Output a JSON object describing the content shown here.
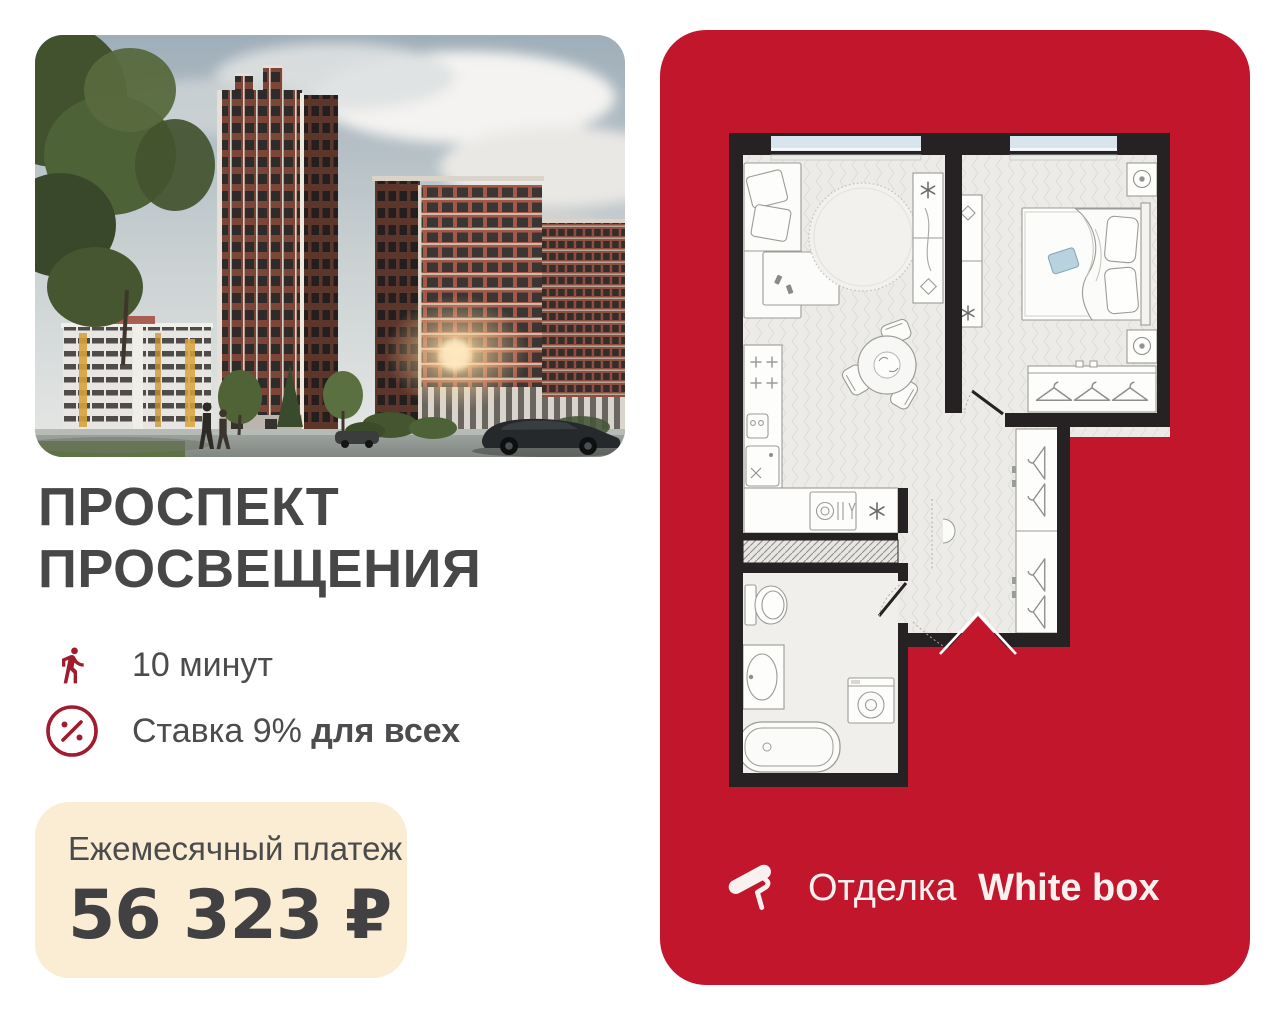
{
  "title": {
    "line1": "ПРОСПЕКТ",
    "line2": "ПРОСВЕЩЕНИЯ"
  },
  "features": [
    {
      "icon": "walking-person-icon",
      "text": "10 минут"
    },
    {
      "icon": "percent-circle-icon",
      "prefix": "Ставка 9%",
      "bold": "для всех"
    }
  ],
  "payment": {
    "label": "Ежемесячный платеж",
    "amount": "56 323 ₽"
  },
  "finish": {
    "icon": "paint-roller-icon",
    "prefix": "Отделка",
    "bold": "White box"
  },
  "colors": {
    "card_red": "#C1162C",
    "icon_red": "#A01B2D",
    "title_gray": "#474747",
    "text_gray": "#4C4C4E",
    "beige": "#FAEDD4",
    "wall_dark": "#262122",
    "window_blue": "#D9E5EE",
    "floor_gray": "#ECEBE7"
  }
}
